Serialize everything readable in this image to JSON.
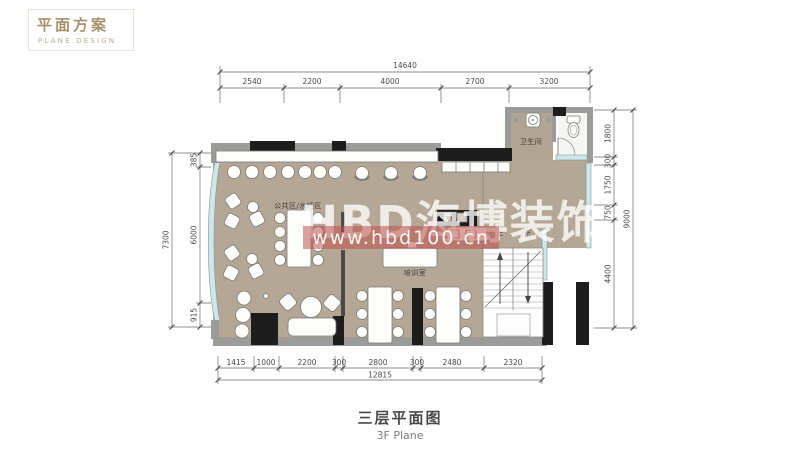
{
  "header": {
    "title": "平面方案",
    "subtitle": "PLANE DESIGN"
  },
  "footer": {
    "title": "三层平面图",
    "subtitle": "3F Plane"
  },
  "watermark": {
    "brand": "HBD海博装饰",
    "url": "www.hbd100.cn"
  },
  "plan_labels": {
    "bathroom": "卫生间",
    "public_area": "公共区/水吧区",
    "training_room": "培训室",
    "stair_up": "上",
    "stair_down": "下"
  },
  "dimensions": {
    "top": {
      "total": "14640",
      "segments": [
        "2540",
        "2200",
        "4000",
        "2700",
        "3200"
      ]
    },
    "bottom": {
      "total": "12815",
      "segments": [
        "1415",
        "1000",
        "2200",
        "300",
        "2800",
        "300",
        "2480",
        "2320"
      ]
    },
    "left": {
      "total": "7300",
      "segments": [
        "385",
        "6000",
        "915"
      ]
    },
    "right": {
      "total": "9000",
      "segments": [
        "1800",
        "300",
        "1750",
        "750",
        "4400"
      ]
    }
  },
  "colors": {
    "accent_tan": "#a8906c",
    "floor_beige": "#b4a795",
    "wall_dark": "#1d1d1d",
    "wall_gray": "#9b9b99",
    "glass_blue": "#cfe7e9",
    "watermark_red": "#c0524d"
  }
}
